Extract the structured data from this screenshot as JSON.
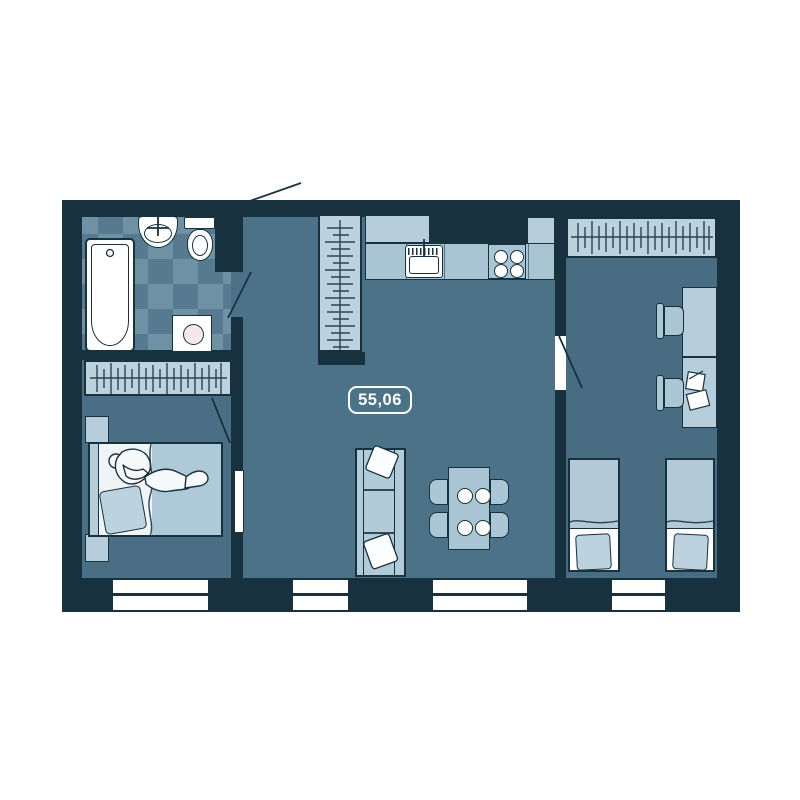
{
  "floor_plan": {
    "area_label": "55,06",
    "palette": {
      "wall": "#17313e",
      "floor_main": "#4c7288",
      "floor_bedroom_left": "#4a6f85",
      "floor_bedroom_right": "#486d83",
      "tile_light": "#6e91a3",
      "tile_dark": "#567a8f",
      "furniture_light": "#b6cedb",
      "furniture_mid": "#a9c4d3",
      "fixture_white": "#ffffff"
    },
    "icons": [
      "bathtub-icon",
      "bathroom-sink-icon",
      "toilet-icon",
      "washing-machine-icon",
      "hangers-icon",
      "kitchen-sink-icon",
      "stove-icon",
      "dining-table-icon",
      "plate-icon",
      "sofa-icon",
      "pillow-icon",
      "double-bed-icon",
      "sleeping-person-icon",
      "single-bed-icon",
      "desk-icon",
      "chair-icon",
      "papers-icon",
      "window-icon",
      "door-swing-icon",
      "door-leaf-icon"
    ]
  }
}
